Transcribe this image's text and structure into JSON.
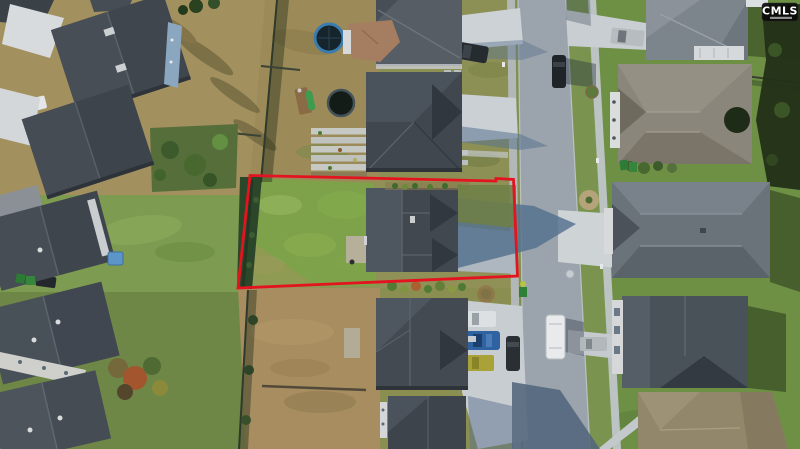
{
  "meta": {
    "description": "Aerial drone photograph of a suburban neighborhood; a residential lot and its neighboring home are outlined in red",
    "width_px": 800,
    "height_px": 449
  },
  "watermark": {
    "label": "CMLS",
    "style": "white logo on black rounded tag, top-right corner"
  },
  "boundary": {
    "points": "250,175.5 496,181 496,178.5 513.5,179.5 517.5,276 238,288",
    "color": "#e31420",
    "meaning": "outlined property lot"
  },
  "palette": {
    "base_ground": "#8f9157",
    "backyard_tan": "#a3905f",
    "lawn_green": "#7d9b51",
    "field_brown": "#a78d5f",
    "right_lawn_green": "#6d9045",
    "road_gray": "#9ba4ac",
    "concrete": "#cdd2d6",
    "roof_dark_gray": "#41484f",
    "roof_tan": "#8b867b",
    "shadow_blue": "#54708e",
    "hedge_dark_green": "#2c4629"
  },
  "scene": {
    "elements": [
      "red property boundary",
      "vacant grass lot",
      "single-family homes with gray shingle roofs",
      "residential street running vertically",
      "sidewalks and driveways",
      "parked cars",
      "white van",
      "trampolines",
      "playset with green slide",
      "raised garden beds",
      "backyard fences",
      "trees and shrubs"
    ]
  }
}
